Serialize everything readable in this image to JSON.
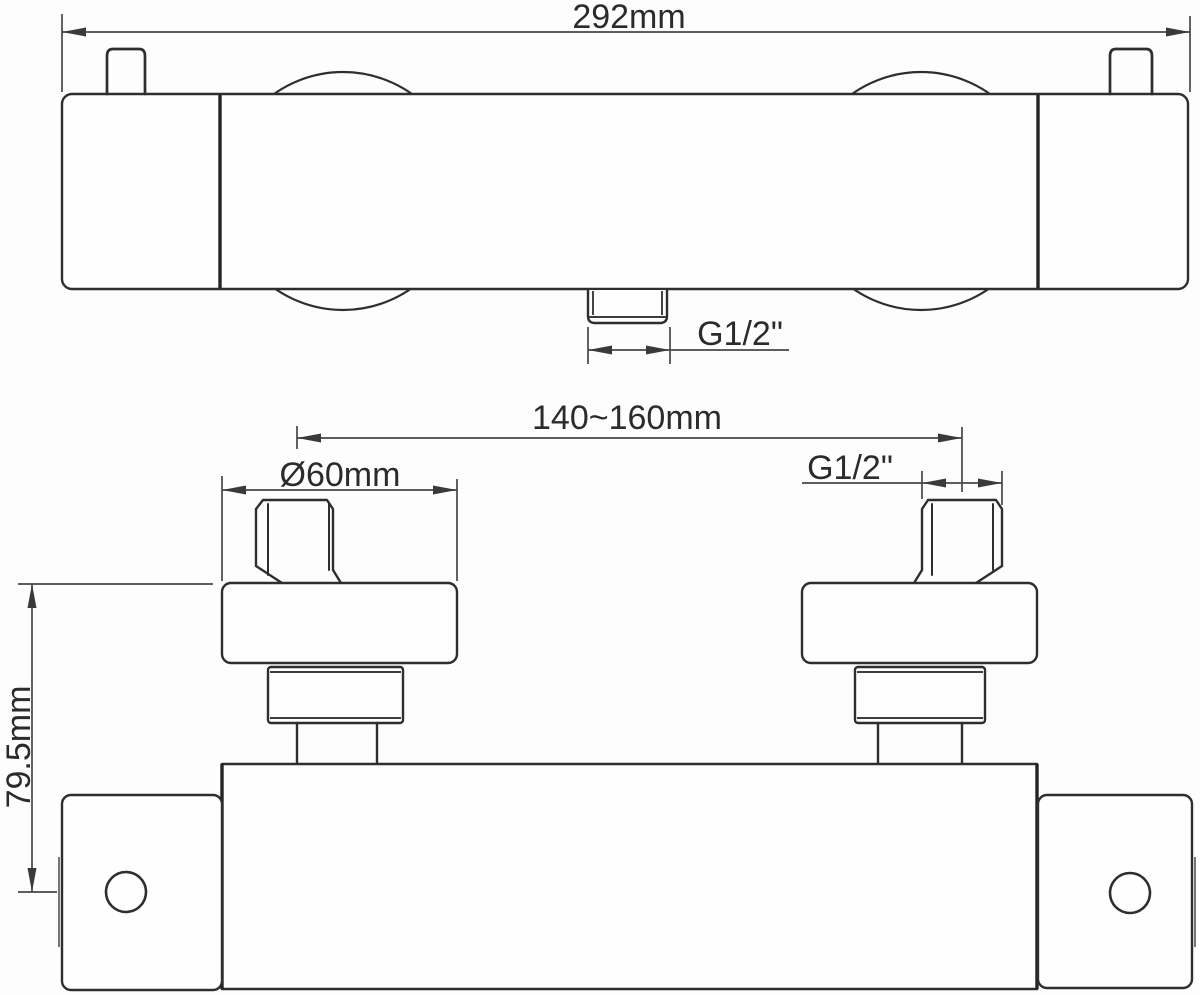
{
  "diagram": {
    "type": "technical-dimension-drawing",
    "subject": "thermostatic shower mixer bar valve, top view and front view",
    "top_view": {
      "overall_width_label": "292mm",
      "outlet_thread_label": "G1/2\""
    },
    "front_view": {
      "inlet_spacing_label": "140~160mm",
      "escutcheon_diameter_label": "Ø60mm",
      "inlet_thread_label": "G1/2\"",
      "mounting_height_label": "79.5mm"
    },
    "colors": {
      "background": "#fdfdfd",
      "outline": "#2e2e2e",
      "dimension_lines": "#474747",
      "text": "#2b2b2b"
    }
  }
}
